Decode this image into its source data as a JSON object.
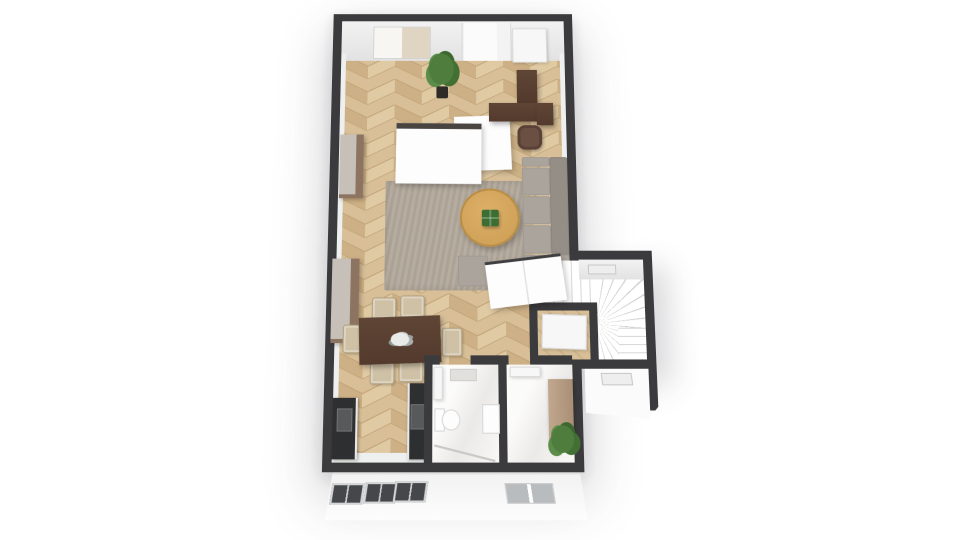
{
  "meta": {
    "view": "3d-floorplan-top-down",
    "visible_text": "none"
  },
  "palette": {
    "background": "#ffffff",
    "wall": "#3b3b3d",
    "wall_face": "#f2f2f2",
    "floor_light": "#d8bf97",
    "floor_mid": "#cdb085",
    "floor_dark": "#c2a478",
    "floor_bright": "#e0caa4",
    "rug": "#b2a89b",
    "sofa": "#aba49c",
    "sofa_dark": "#948e86",
    "wood_dark": "#5f4535",
    "cabinet": "#8d7461",
    "chair": "#cfc1a6",
    "table_round": "#cb9c52",
    "plant": "#3c6d33",
    "counter": "#2e2f30",
    "marble": "#f3f1ef",
    "glass": "#45474a",
    "tan": "#a98f75"
  },
  "rooms": [
    {
      "name": "study-bedroom",
      "floor": "herringbone-wood"
    },
    {
      "name": "living-room",
      "floor": "herringbone-wood-with-rug"
    },
    {
      "name": "dining-area",
      "floor": "herringbone-wood"
    },
    {
      "name": "kitchen",
      "floor": "herringbone-wood"
    },
    {
      "name": "bathroom",
      "floor": "white-marble"
    },
    {
      "name": "hallway",
      "floor": "white-marble"
    },
    {
      "name": "under-stair-closet",
      "floor": "wood"
    },
    {
      "name": "staircase-annex",
      "floor": "white"
    }
  ],
  "furniture": [
    {
      "name": "bed-with-dark-headboard",
      "room": "study-bedroom"
    },
    {
      "name": "desk",
      "room": "study-bedroom"
    },
    {
      "name": "office-chair",
      "room": "study-bedroom"
    },
    {
      "name": "tall-potted-plant",
      "room": "study-bedroom"
    },
    {
      "name": "sideboard-cabinet-upper",
      "room": "living-room"
    },
    {
      "name": "sideboard-cabinet-lower",
      "room": "dining-area"
    },
    {
      "name": "l-shaped-sofa",
      "room": "living-room"
    },
    {
      "name": "ottoman",
      "room": "living-room"
    },
    {
      "name": "round-coffee-table",
      "room": "living-room"
    },
    {
      "name": "table-plant-box",
      "room": "living-room"
    },
    {
      "name": "area-rug",
      "room": "living-room"
    },
    {
      "name": "white-sideboard",
      "room": "living-room"
    },
    {
      "name": "dining-table",
      "room": "dining-area"
    },
    {
      "name": "dining-chairs-x6",
      "room": "dining-area"
    },
    {
      "name": "flower-centerpiece",
      "room": "dining-area"
    },
    {
      "name": "kitchen-counter-left-with-sink",
      "room": "kitchen"
    },
    {
      "name": "kitchen-counter-right-with-cooktop",
      "room": "kitchen"
    },
    {
      "name": "toilet",
      "room": "bathroom"
    },
    {
      "name": "washbasin",
      "room": "bathroom"
    },
    {
      "name": "shower",
      "room": "bathroom"
    },
    {
      "name": "wall-shelf",
      "room": "bathroom"
    },
    {
      "name": "wardrobe",
      "room": "hallway"
    },
    {
      "name": "potted-plant",
      "room": "hallway"
    },
    {
      "name": "winder-staircase",
      "room": "staircase-annex"
    }
  ],
  "openings": [
    "top-window-with-blind",
    "glass-wall",
    "entry-door",
    "bathroom-door",
    "hallway-door",
    "closet-door",
    "stair-window-slit-upper",
    "stair-window-slit-lower",
    "facade-window-1",
    "facade-window-2",
    "facade-window-3",
    "facade-window-framed"
  ]
}
